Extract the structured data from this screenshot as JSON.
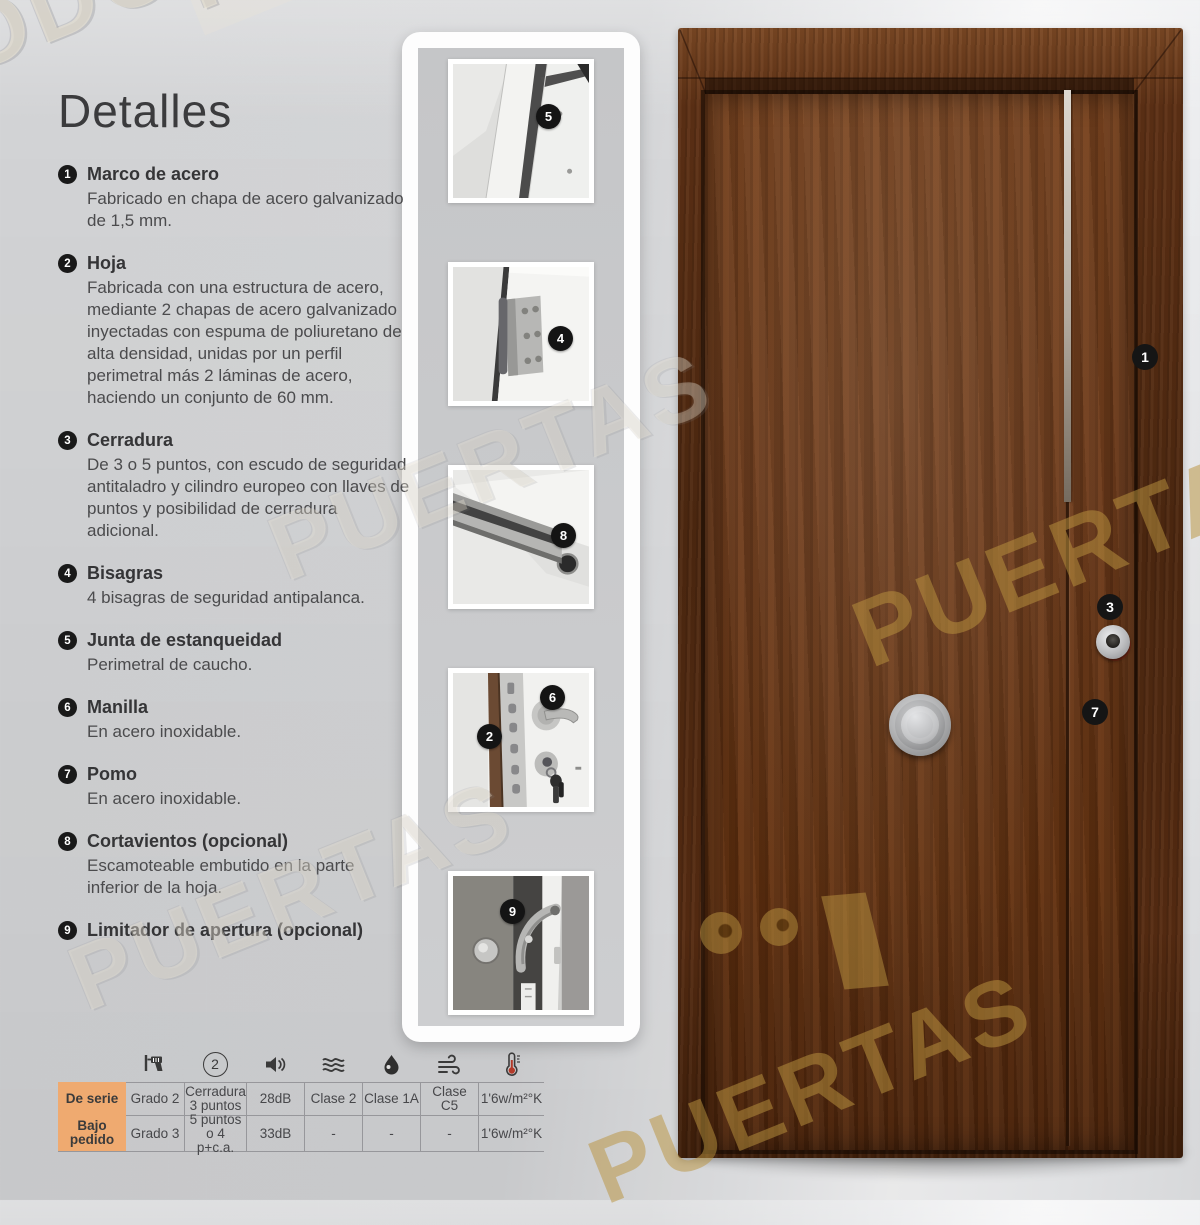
{
  "page": {
    "heading": "Detalles"
  },
  "features": [
    {
      "num": "1",
      "title": "Marco de acero",
      "body": "Fabricado en chapa de acero galvanizado de 1,5 mm."
    },
    {
      "num": "2",
      "title": "Hoja",
      "body": "Fabricada con una estructura de acero, mediante 2 chapas de acero galvanizado inyectadas con espuma de poliuretano de alta densidad, unidas por un perfil perimetral más 2 láminas de acero, haciendo un conjunto de 60 mm."
    },
    {
      "num": "3",
      "title": "Cerradura",
      "body": "De 3 o 5 puntos, con escudo de seguridad antitaladro y cilindro europeo con llaves de puntos y posibilidad de cerradura adicional."
    },
    {
      "num": "4",
      "title": "Bisagras",
      "body": "4 bisagras de seguridad antipalanca."
    },
    {
      "num": "5",
      "title": "Junta de estanqueidad",
      "body": "Perimetral de caucho."
    },
    {
      "num": "6",
      "title": "Manilla",
      "body": "En acero inoxidable."
    },
    {
      "num": "7",
      "title": "Pomo",
      "body": "En acero inoxidable."
    },
    {
      "num": "8",
      "title": "Cortavientos (opcional)",
      "body": "Escamoteable embutido en la parte inferior de la hoja."
    },
    {
      "num": "9",
      "title": "Limitador de apertura (opcional)",
      "body": ""
    }
  ],
  "photo_strip": {
    "photos": [
      {
        "name": "junta-de-estanqueidad",
        "callouts": [
          "5"
        ]
      },
      {
        "name": "bisagra",
        "callouts": [
          "4"
        ]
      },
      {
        "name": "cortavientos",
        "callouts": [
          "8"
        ]
      },
      {
        "name": "cerradura-manilla",
        "callouts": [
          "6",
          "2"
        ]
      },
      {
        "name": "limitador-de-apertura",
        "callouts": [
          "9"
        ]
      }
    ]
  },
  "door": {
    "markers": [
      "1",
      "3",
      "7"
    ]
  },
  "spec_table": {
    "lock_points_badge": "2",
    "icons": [
      "drill-icon",
      "lock-points-icon",
      "speaker-icon",
      "waves-icon",
      "droplet-icon",
      "wind-icon",
      "thermometer-icon"
    ],
    "rows": [
      {
        "label": "De serie",
        "values": [
          "Grado 2",
          "Cerradura 3 puntos",
          "28dB",
          "Clase 2",
          "Clase 1A",
          "Clase C5",
          "1'6w/m²°K"
        ]
      },
      {
        "label": "Bajo pedido",
        "values": [
          "Grado 3",
          "5 puntos o 4 p+c.a.",
          "33dB",
          "-",
          "-",
          "-",
          "1'6w/m²°K"
        ]
      }
    ]
  },
  "watermark": {
    "todo": "TODO",
    "puertas": "PUERTAS"
  }
}
